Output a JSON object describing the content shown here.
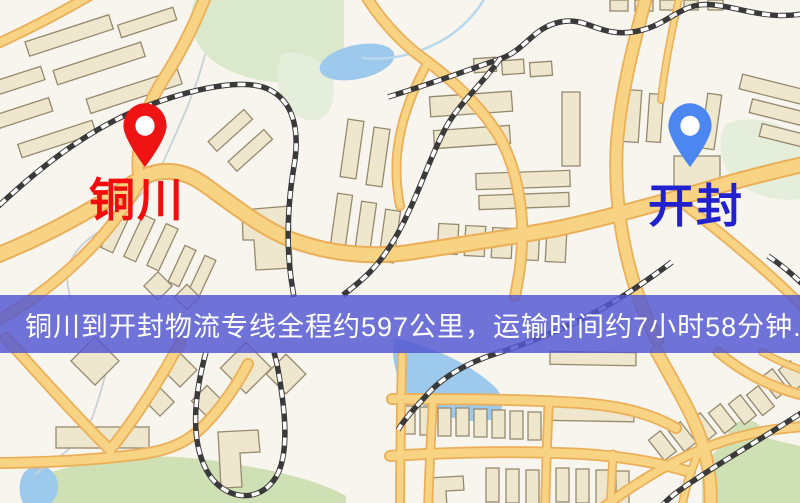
{
  "banner": {
    "text": "铜川到开封物流专线全程约597公里，运输时间约7小时58分钟.",
    "background_color": "#5558d0",
    "text_color": "#ffffff",
    "distance_text": "约597公里",
    "duration_text": "约7小时58分钟"
  },
  "markers": {
    "origin": {
      "label": "铜川",
      "pin_color": "#ee1414",
      "label_color": "#f20c0c"
    },
    "destination": {
      "label": "开封",
      "pin_color": "#4c86f0",
      "label_color": "#2121cd"
    }
  },
  "map": {
    "theme_colors": {
      "background": "#f8f4ee",
      "road_fill": "#f7d383",
      "road_casing": "#eaaf58",
      "water": "#9cc9ec",
      "park": "#dae8cb",
      "building": "#efe7cd",
      "railway": "#3a3a3a"
    }
  }
}
